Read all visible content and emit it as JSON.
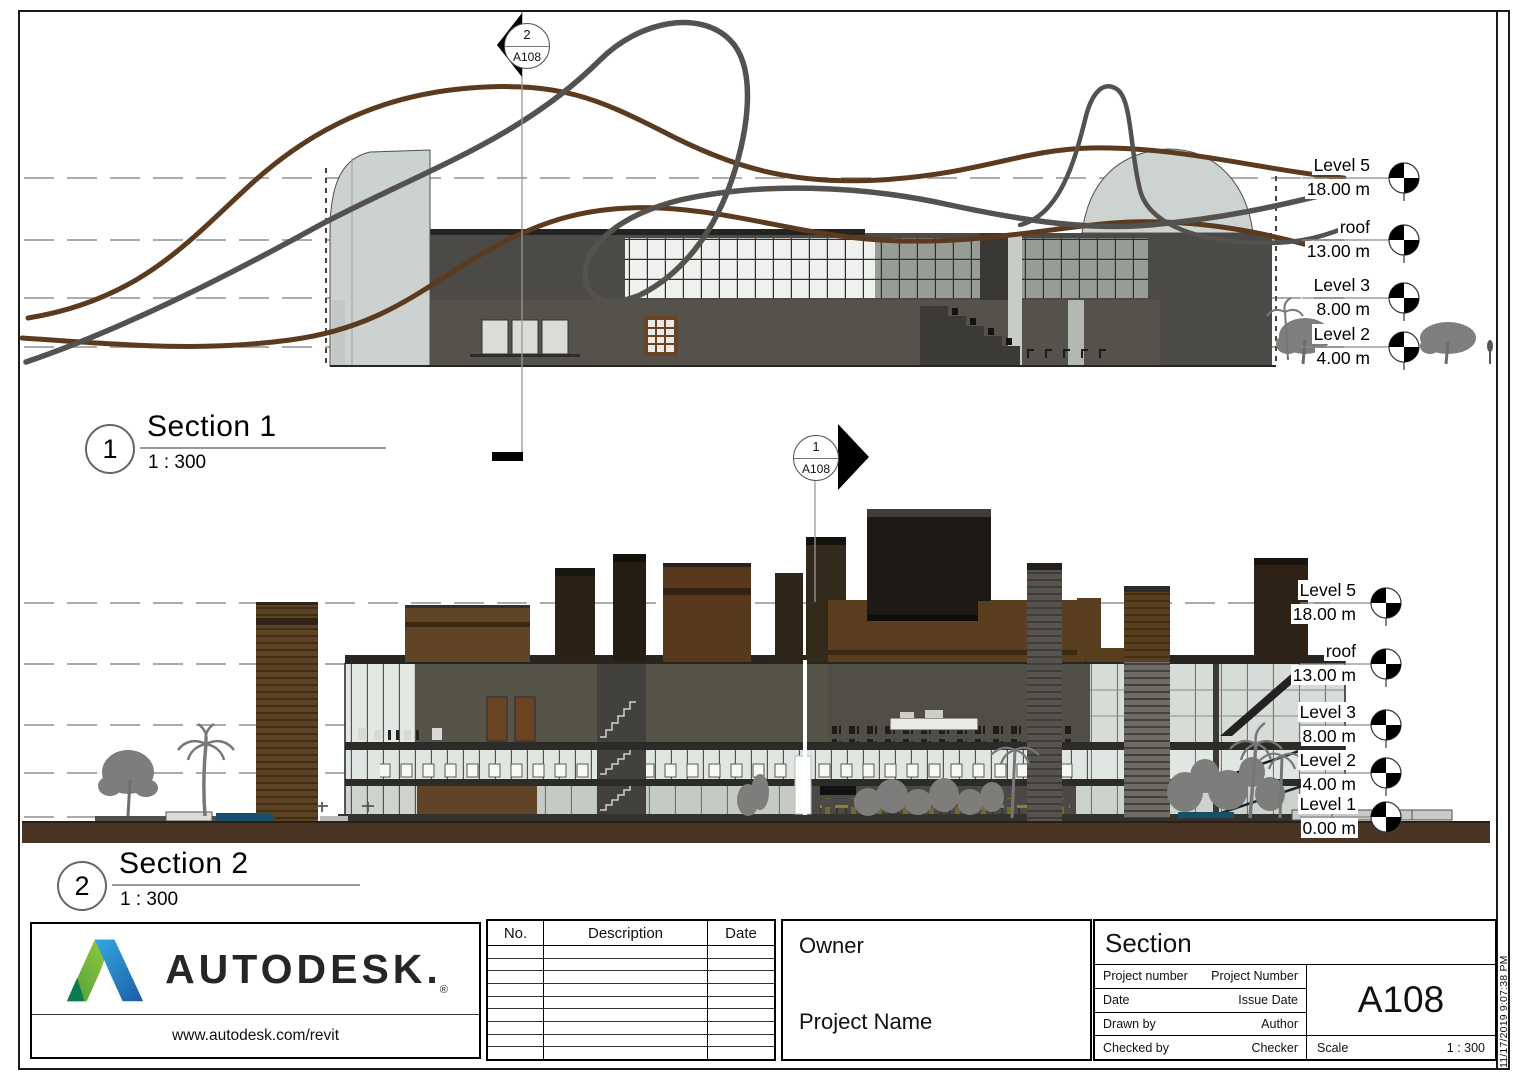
{
  "viewports": {
    "s1": {
      "number": "1",
      "title": "Section 1",
      "scale": "1 : 300"
    },
    "s2": {
      "number": "2",
      "title": "Section 2",
      "scale": "1 : 300"
    }
  },
  "markers": {
    "top": {
      "detail": "2",
      "sheet": "A108"
    },
    "mid": {
      "detail": "1",
      "sheet": "A108"
    }
  },
  "levels_s1": [
    {
      "name": "Level 5",
      "elev": "18.00 m"
    },
    {
      "name": "roof",
      "elev": "13.00 m"
    },
    {
      "name": "Level 3",
      "elev": "8.00 m"
    },
    {
      "name": "Level 2",
      "elev": "4.00 m"
    }
  ],
  "levels_s2": [
    {
      "name": "Level 5",
      "elev": "18.00 m"
    },
    {
      "name": "roof",
      "elev": "13.00 m"
    },
    {
      "name": "Level 3",
      "elev": "8.00 m"
    },
    {
      "name": "Level 2",
      "elev": "4.00 m"
    },
    {
      "name": "Level 1",
      "elev": "0.00 m"
    }
  ],
  "titleblock": {
    "logo": {
      "wordmark": "AUTODESK.",
      "reg": "®",
      "url": "www.autodesk.com/revit"
    },
    "revisions": {
      "headers": [
        "No.",
        "Description",
        "Date"
      ]
    },
    "owner": "Owner",
    "project_name": "Project Name",
    "view_name": "Section",
    "fields": [
      {
        "label": "Project number",
        "value": "Project Number"
      },
      {
        "label": "Date",
        "value": "Issue Date"
      },
      {
        "label": "Drawn by",
        "value": "Author"
      },
      {
        "label": "Checked by",
        "value": "Checker"
      }
    ],
    "sheet_number": "A108",
    "scale_label": "Scale",
    "scale_value": "1 : 300"
  },
  "plot_stamp": "11/17/2019 9:07:38 PM",
  "colors": {
    "track_brown": "#5b3a1d",
    "track_gray": "#54524f",
    "ground_brown": "#4a3524",
    "mass_brown": "#5f4526",
    "mass_dark": "#1d1a15",
    "glass": "#e3e8e4"
  }
}
